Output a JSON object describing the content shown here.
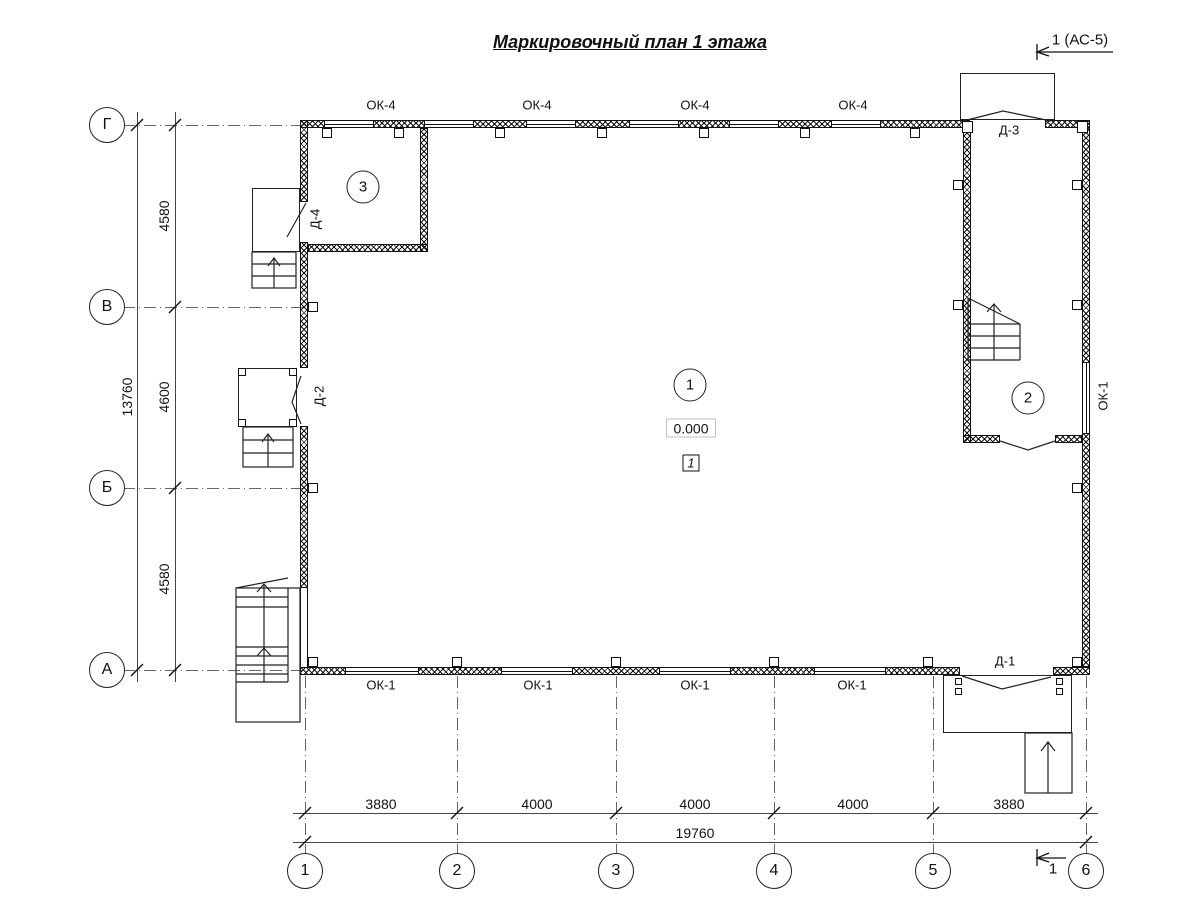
{
  "title": "Маркировочный план 1 этажа",
  "section_marks": {
    "top": "1 (АС-5)",
    "bottom": "1"
  },
  "axes": {
    "rows": [
      "Г",
      "В",
      "Б",
      "А"
    ],
    "cols": [
      "1",
      "2",
      "3",
      "4",
      "5",
      "6"
    ]
  },
  "dimensions": {
    "left_segments": [
      "4580",
      "4600",
      "4580"
    ],
    "left_total": "13760",
    "bottom_segments": [
      "3880",
      "4000",
      "4000",
      "4000",
      "3880"
    ],
    "bottom_total": "19760"
  },
  "windows": {
    "top_label": "ОК-4",
    "bottom_label": "ОК-1",
    "right_label": "ОК-1"
  },
  "doors": {
    "d1": "Д-1",
    "d2": "Д-2",
    "d3": "Д-3",
    "d4": "Д-4"
  },
  "rooms": {
    "hall": "1",
    "wing": "2",
    "corner": "3"
  },
  "elevation": "0.000",
  "floor_type_mark": "1"
}
